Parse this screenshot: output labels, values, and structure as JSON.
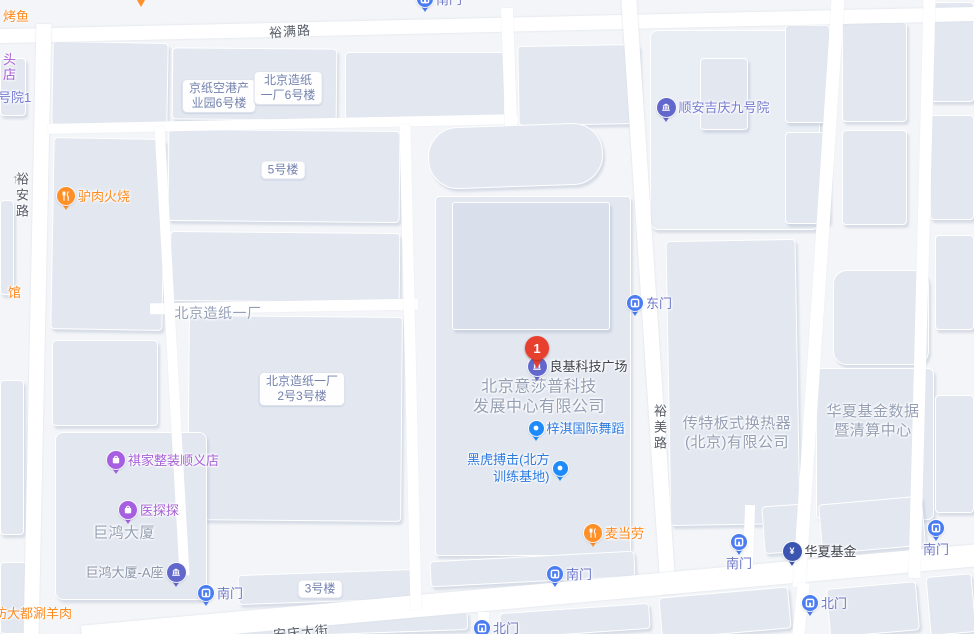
{
  "map": {
    "road_labels": [
      {
        "text": "裕满路",
        "x": 269,
        "y": 21,
        "rotate": -4,
        "vertical": false
      },
      {
        "text": "裕安路",
        "x": 12,
        "y": 172,
        "rotate": 0,
        "vertical": true
      },
      {
        "text": "裕美路",
        "x": 650,
        "y": 404,
        "rotate": 0,
        "vertical": true
      },
      {
        "text": "安庆大街",
        "x": 273,
        "y": 622,
        "rotate": -5,
        "vertical": false
      }
    ],
    "area_labels": [
      {
        "lines": [
          "北京造纸一厂"
        ],
        "x": 218,
        "y": 314,
        "size": 14
      },
      {
        "lines": [
          "北京意莎普科技",
          "发展中心有限公司"
        ],
        "x": 539,
        "y": 398,
        "size": 16
      },
      {
        "lines": [
          "传特板式换热器",
          "(北京)有限公司"
        ],
        "x": 737,
        "y": 433,
        "size": 15
      },
      {
        "lines": [
          "华夏基金数据",
          "暨清算中心"
        ],
        "x": 873,
        "y": 421,
        "size": 15
      },
      {
        "lines": [
          "巨鸿大厦"
        ],
        "x": 124,
        "y": 533,
        "size": 15
      }
    ],
    "bubbles": [
      {
        "lines": [
          "京纸空港产",
          "业园6号楼"
        ],
        "x": 219,
        "y": 96
      },
      {
        "lines": [
          "北京造纸",
          "一厂6号楼"
        ],
        "x": 288,
        "y": 88
      },
      {
        "lines": [
          "5号楼"
        ],
        "x": 283,
        "y": 170
      },
      {
        "lines": [
          "北京造纸一厂",
          "2号3号楼"
        ],
        "x": 302,
        "y": 389
      },
      {
        "lines": [
          "3号楼"
        ],
        "x": 320,
        "y": 589
      }
    ],
    "pois": [
      {
        "type": "food",
        "name": "驴肉火烧",
        "x": 66,
        "y": 196,
        "side": "right"
      },
      {
        "type": "food",
        "name": "麦当劳",
        "x": 593,
        "y": 533,
        "side": "right"
      },
      {
        "type": "purple",
        "name": "祺家整装顺义店",
        "x": 116,
        "y": 460,
        "side": "right"
      },
      {
        "type": "purple",
        "name": "医探探",
        "x": 128,
        "y": 510,
        "side": "right"
      },
      {
        "type": "civic",
        "name": "顺安吉庆九号院",
        "x": 666,
        "y": 107,
        "side": "right",
        "label_color": "violet"
      },
      {
        "type": "civic",
        "name": "良基科技广场",
        "x": 537,
        "y": 366,
        "side": "right",
        "label_color": "dark"
      },
      {
        "type": "civic",
        "name": "巨鸿大厦-A座",
        "x": 176,
        "y": 572,
        "side": "left",
        "label_color": "gray"
      },
      {
        "type": "fund",
        "name": "华夏基金",
        "x": 792,
        "y": 551,
        "side": "right",
        "label_color": "dark"
      },
      {
        "type": "bluedot",
        "name": "梓淇国际舞蹈",
        "x": 536,
        "y": 428,
        "side": "right"
      },
      {
        "type": "bluedot",
        "name": "黑虎搏击(北方训练基地)",
        "lines": [
          "黑虎搏击(北方",
          "训练基地)"
        ],
        "x": 560,
        "y": 468,
        "side": "left"
      },
      {
        "type": "gate",
        "name": "东门",
        "x": 635,
        "y": 303,
        "side": "right"
      },
      {
        "type": "gate",
        "name": "南门",
        "x": 206,
        "y": 593,
        "side": "right"
      },
      {
        "type": "gate",
        "name": "南门",
        "x": 555,
        "y": 574,
        "side": "right"
      },
      {
        "type": "gate",
        "name": "北门",
        "x": 482,
        "y": 628,
        "side": "right"
      },
      {
        "type": "gate",
        "name": "南门",
        "x": 739,
        "y": 542,
        "side": "below"
      },
      {
        "type": "gate",
        "name": "南门",
        "x": 936,
        "y": 528,
        "side": "below"
      },
      {
        "type": "gate",
        "name": "北门",
        "x": 810,
        "y": 603,
        "side": "right"
      },
      {
        "type": "gate",
        "name": "南门",
        "x": 425,
        "y": -1,
        "side": "right"
      },
      {
        "type": "redpin",
        "name": "1",
        "x": 537,
        "y": 348
      },
      {
        "type": "food_tail",
        "name": "",
        "x": 141,
        "y": 2
      }
    ],
    "street_texts": [
      {
        "text": "烤鱼",
        "x": 3,
        "y": 14,
        "color": "orange"
      },
      {
        "text": "头",
        "x": 3,
        "y": 57,
        "color": "purple"
      },
      {
        "text": "店",
        "x": 3,
        "y": 72,
        "color": "purple"
      },
      {
        "text": "号院1",
        "x": -2,
        "y": 95,
        "color": "violet"
      },
      {
        "text": "馆",
        "x": 8,
        "y": 290,
        "color": "orange"
      },
      {
        "text": "坊大都涮羊肉",
        "x": -6,
        "y": 611,
        "color": "orange"
      },
      {
        "text": "↑",
        "x": 12,
        "y": 179,
        "color": "muted"
      }
    ],
    "colors": {
      "background": "#f3f5f8",
      "building": "#e2e7f0",
      "road": "#ffffff",
      "marker_food": "#ff9027",
      "marker_purple": "#a55fe0",
      "marker_civic": "#6267cc",
      "marker_fund": "#3c55b0",
      "marker_bluedot": "#1d8cfa",
      "marker_gate": "#4a7cf2",
      "marker_redpin": "#e8402f",
      "label_orange": "#ff8a1e",
      "label_purple": "#a75fd8",
      "label_violet": "#767bd1",
      "label_blue": "#2b7ae0",
      "label_gate": "#6e77c6",
      "label_dark": "#3e434d",
      "label_gray": "#8b94a9",
      "label_area": "#96a0b5",
      "label_road": "#555b66",
      "label_bubble": "#7381ae",
      "label_muted": "#9aa2b0"
    }
  }
}
